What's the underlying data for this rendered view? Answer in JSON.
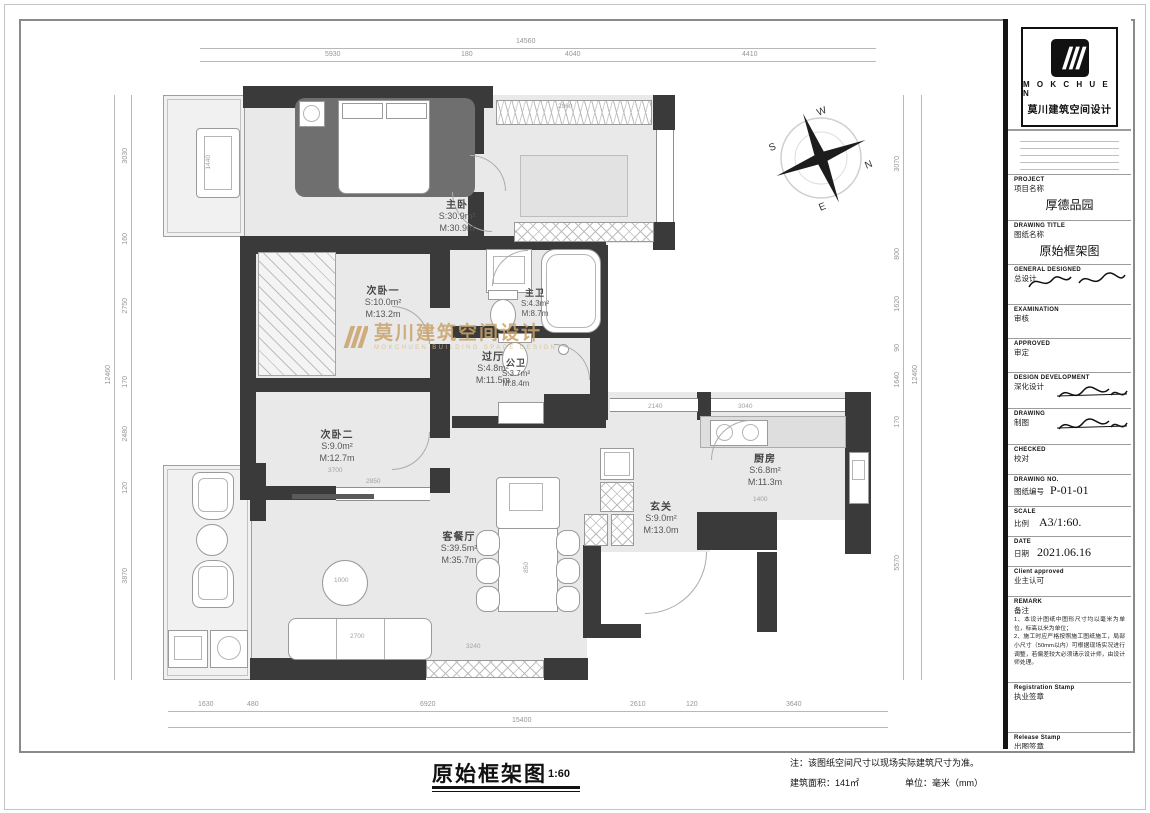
{
  "titleblock": {
    "brand": {
      "en": "M O K C H U E N",
      "cn": "莫川建筑空间设计"
    },
    "fields": {
      "project": {
        "en": "PROJECT",
        "cn": "项目名称",
        "value": "厚德品园"
      },
      "drawing_title": {
        "en": "DRAWING TITLE",
        "cn": "图纸名称",
        "value": "原始框架图"
      },
      "general_designed": {
        "en": "GENERAL  DESIGNED",
        "cn": "总设计"
      },
      "examination": {
        "en": "EXAMINATION",
        "cn": "审核"
      },
      "approved": {
        "en": "APPROVED",
        "cn": "审定"
      },
      "design_development": {
        "en": "DESIGN DEVELOPMENT",
        "cn": "深化设计"
      },
      "drawing": {
        "en": "DRAWING",
        "cn": "制图"
      },
      "checked": {
        "en": "CHECKED",
        "cn": "校对"
      },
      "drawing_no": {
        "en": "DRAWING NO.",
        "cn": "图纸编号",
        "value": "P-01-01"
      },
      "scale": {
        "en": "SCALE",
        "cn": "比例",
        "value": "A3/1:60."
      },
      "date": {
        "en": "DATE",
        "cn": "日期",
        "value": "2021.06.16"
      },
      "client_approved": {
        "en": "Client approved",
        "cn": "业主认可"
      },
      "remark": {
        "en": "REMARK",
        "cn": "备注"
      },
      "registration_stamp": {
        "en": "Registration Stamp",
        "cn": "执业签章"
      },
      "release_stamp": {
        "en": "Release Stamp",
        "cn": "出图签章"
      }
    },
    "remark_notes": [
      "1、本设计图纸中图形尺寸均以毫米为单位，标高以米为单位；",
      "2、施工时应严格按照施工图纸施工，局部小尺寸（50mm以内）可根据现场实况进行调整，若偏差较大必须请示设计师，由设计师处理。"
    ]
  },
  "footer": {
    "title": "原始框架图",
    "scale": "1:60",
    "note": "注：该图纸空间尺寸以现场实际建筑尺寸为准。",
    "area": "建筑面积：141㎡",
    "unit": "单位：毫米（mm）"
  },
  "plan": {
    "watermark": {
      "cn": "莫川建筑空间设计",
      "en": "MOKCHUEN BUILDING SPACE DESIGN"
    },
    "compass": {
      "n": "N",
      "s": "S",
      "e": "E",
      "w": "W"
    },
    "rooms": [
      {
        "name": "主卧",
        "s": "S:30.9m²",
        "m": "M:30.9m"
      },
      {
        "name": "次卧一",
        "s": "S:10.0m²",
        "m": "M:13.2m"
      },
      {
        "name": "次卧二",
        "s": "S:9.0m²",
        "m": "M:12.7m"
      },
      {
        "name": "过厅",
        "s": "S:4.8m²",
        "m": "M:11.5m"
      },
      {
        "name": "主卫",
        "s": "S:4.3m²",
        "m": "M:8.7m"
      },
      {
        "name": "公卫",
        "s": "S:3.7m²",
        "m": "M:8.4m"
      },
      {
        "name": "厨房",
        "s": "S:6.8m²",
        "m": "M:11.3m"
      },
      {
        "name": "玄关",
        "s": "S:9.0m²",
        "m": "M:13.0m"
      },
      {
        "name": "客餐厅",
        "s": "S:39.5m²",
        "m": "M:35.7m"
      }
    ],
    "dims": {
      "top": {
        "total": "14560",
        "segments": [
          "5930",
          "180",
          "4040",
          "4410"
        ]
      },
      "bottom": {
        "total": "15400",
        "segments": [
          "1630",
          "480",
          "6920",
          "2610",
          "120",
          "3640"
        ]
      },
      "left": {
        "total": "12460",
        "segments": [
          "3030",
          "160",
          "2750",
          "170",
          "2480",
          "120",
          "3870"
        ]
      },
      "right": {
        "total": "12460",
        "segments": [
          "3070",
          "800",
          "1620",
          "90",
          "1640",
          "170",
          "5570"
        ]
      },
      "inner": [
        "2960",
        "1440",
        "3700",
        "2850",
        "2700",
        "1000",
        "3240",
        "3040",
        "1400",
        "2140",
        "850"
      ]
    },
    "colors": {
      "wall": "#3a3a3a",
      "floor": "#e9e9e9",
      "watermark": "#c9a36b"
    }
  }
}
